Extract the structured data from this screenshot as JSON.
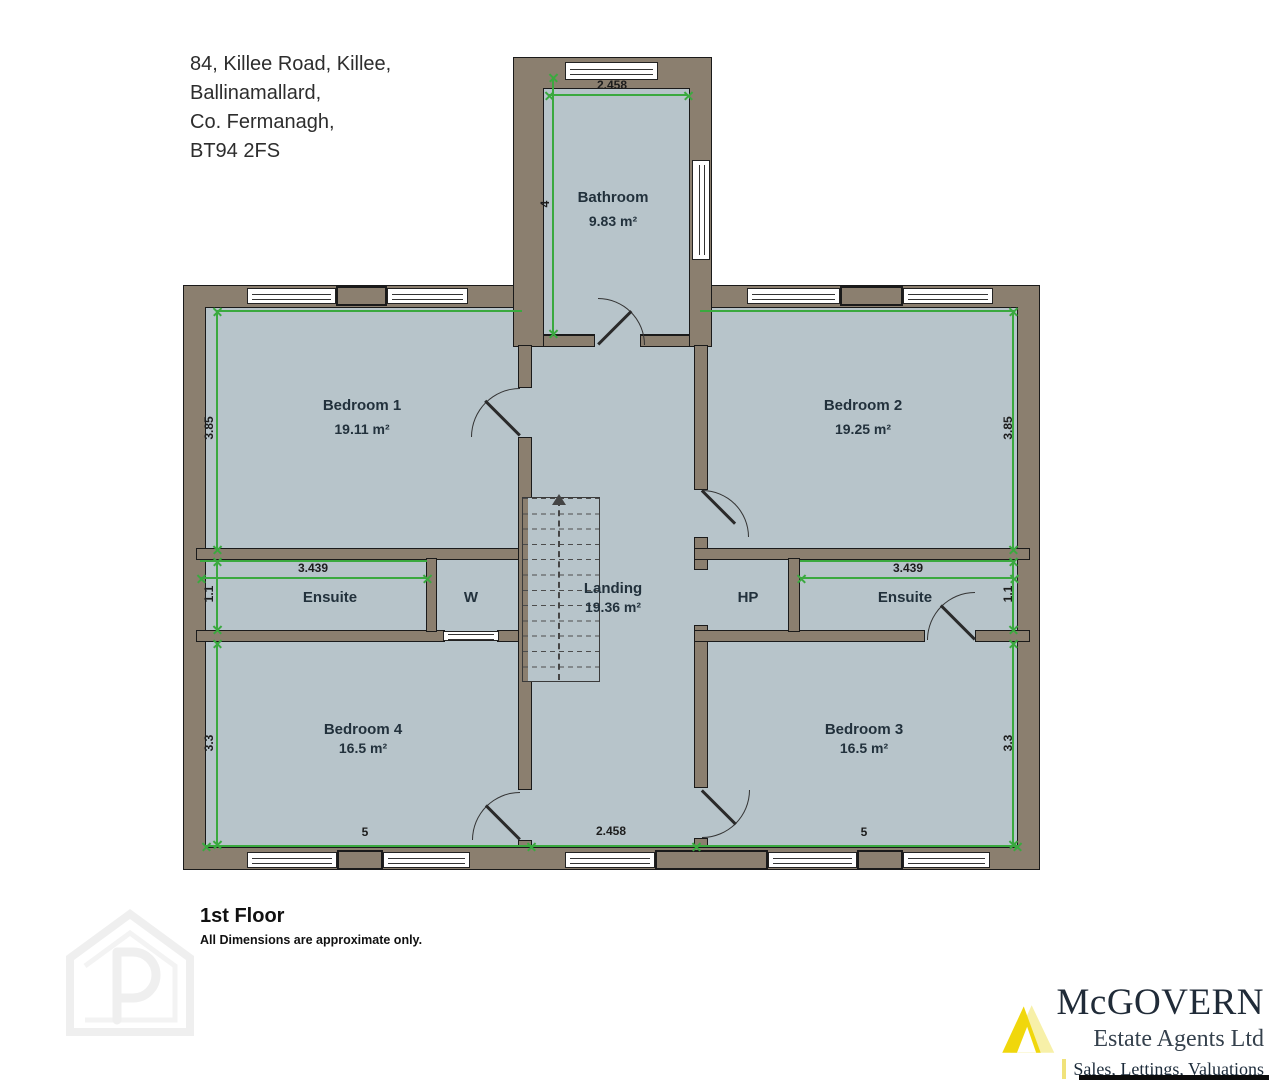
{
  "address": {
    "lines": [
      "84, Killee Road, Killee,",
      "Ballinamallard,",
      "Co. Fermanagh,",
      "BT94 2FS"
    ]
  },
  "floor": {
    "title": "1st Floor",
    "disclaimer": "All Dimensions are approximate only."
  },
  "rooms": {
    "bathroom": {
      "name": "Bathroom",
      "area": "9.83 m²"
    },
    "bedroom1": {
      "name": "Bedroom 1",
      "area": "19.11 m²"
    },
    "bedroom2": {
      "name": "Bedroom 2",
      "area": "19.25 m²"
    },
    "bedroom3": {
      "name": "Bedroom 3",
      "area": "16.5 m²"
    },
    "bedroom4": {
      "name": "Bedroom 4",
      "area": "16.5 m²"
    },
    "ensuite_left": {
      "name": "Ensuite"
    },
    "ensuite_right": {
      "name": "Ensuite"
    },
    "wardrobe": {
      "name": "W"
    },
    "hotpress": {
      "name": "HP"
    },
    "landing": {
      "name": "Landing",
      "area": "19.36 m²"
    }
  },
  "dimensions": {
    "bathroom_width": "2.458",
    "bathroom_depth": "4",
    "bedroom1_depth": "3.85",
    "bedroom2_depth": "3.85",
    "ensuite_left_width": "3.439",
    "ensuite_left_depth": "1.1",
    "ensuite_right_width": "3.439",
    "ensuite_right_depth": "1.1",
    "bedroom4_depth": "3.3",
    "bedroom3_depth": "3.3",
    "bedroom4_width": "5",
    "bedroom3_width": "5",
    "hall_width": "2.458"
  },
  "branding": {
    "name": "McGOVERN",
    "subtitle": "Estate Agents Ltd",
    "tagline": "Sales, Lettings, Valuations"
  },
  "colors": {
    "wall": "#8b7f6f",
    "floor": "#b7c4ca",
    "dimension_green": "#3aa93f",
    "logo_yellow": "#f0d70c",
    "logo_navy": "#202b38"
  }
}
